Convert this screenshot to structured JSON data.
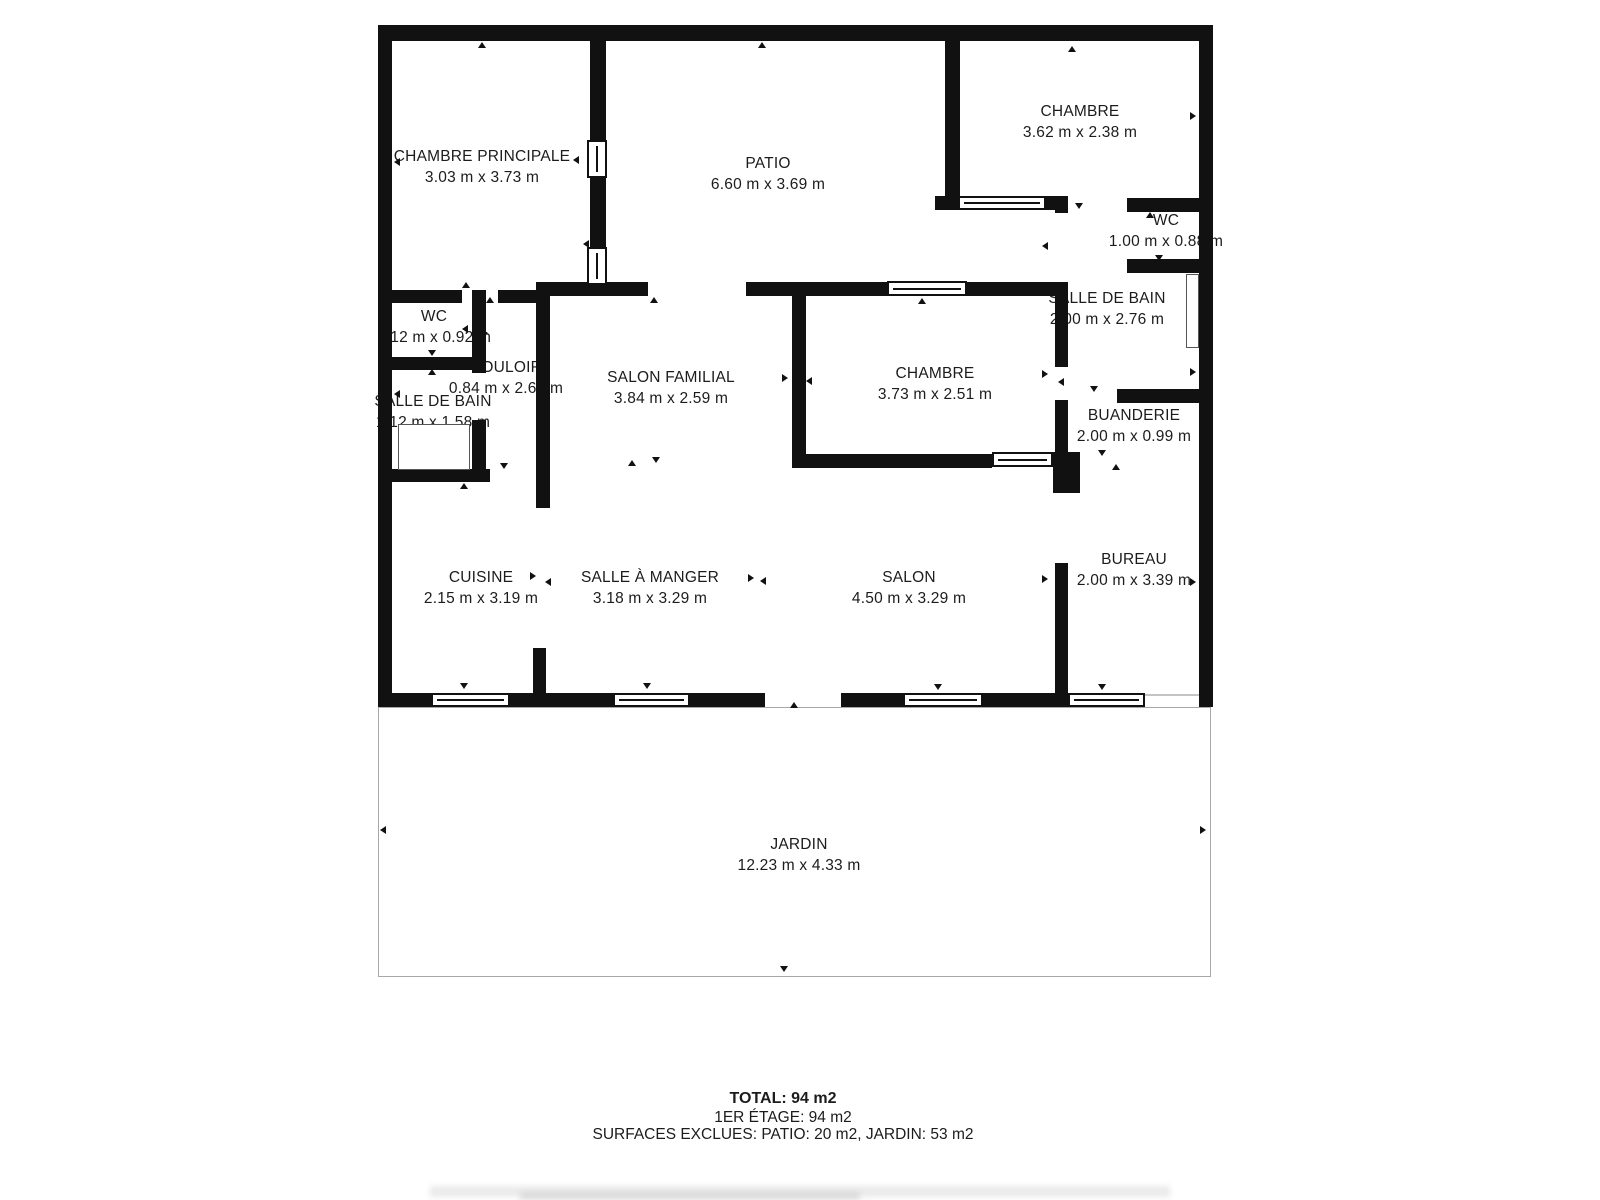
{
  "rooms": [
    {
      "name": "CHAMBRE PRINCIPALE",
      "dims": "3.03 m x 3.73 m"
    },
    {
      "name": "PATIO",
      "dims": "6.60 m x 3.69 m"
    },
    {
      "name": "CHAMBRE",
      "dims": "3.62 m x 2.38 m"
    },
    {
      "name": "WC",
      "dims": "1.00 m x 0.88 m"
    },
    {
      "name": "SALLE DE BAIN",
      "dims": "2.00 m x 2.76 m"
    },
    {
      "name": "BUANDERIE",
      "dims": "2.00 m x 0.99 m"
    },
    {
      "name": "BUREAU",
      "dims": "2.00 m x 3.39 m"
    },
    {
      "name": "WC",
      "dims": "1.12 m x 0.92 m"
    },
    {
      "name": "COULOIR",
      "dims": "0.84 m x 2.60 m"
    },
    {
      "name": "SALLE DE BAIN",
      "dims": "1.12 m x 1.58 m"
    },
    {
      "name": "SALON FAMILIAL",
      "dims": "3.84 m x 2.59 m"
    },
    {
      "name": "CHAMBRE",
      "dims": "3.73 m x 2.51 m"
    },
    {
      "name": "CUISINE",
      "dims": "2.15 m x 3.19 m"
    },
    {
      "name": "SALLE À MANGER",
      "dims": "3.18 m x 3.29 m"
    },
    {
      "name": "SALON",
      "dims": "4.50 m x 3.29 m"
    },
    {
      "name": "JARDIN",
      "dims": "12.23 m x 4.33 m"
    }
  ],
  "summary": {
    "total": "TOTAL: 94 m2",
    "floor": "1ER ÉTAGE: 94 m2",
    "excluded": "SURFACES EXCLUES: PATIO: 20 m2, JARDIN: 53 m2"
  },
  "colors": {
    "wall": "#111111",
    "jardin_border": "#a8a8a8",
    "text": "#1c1c1c"
  }
}
